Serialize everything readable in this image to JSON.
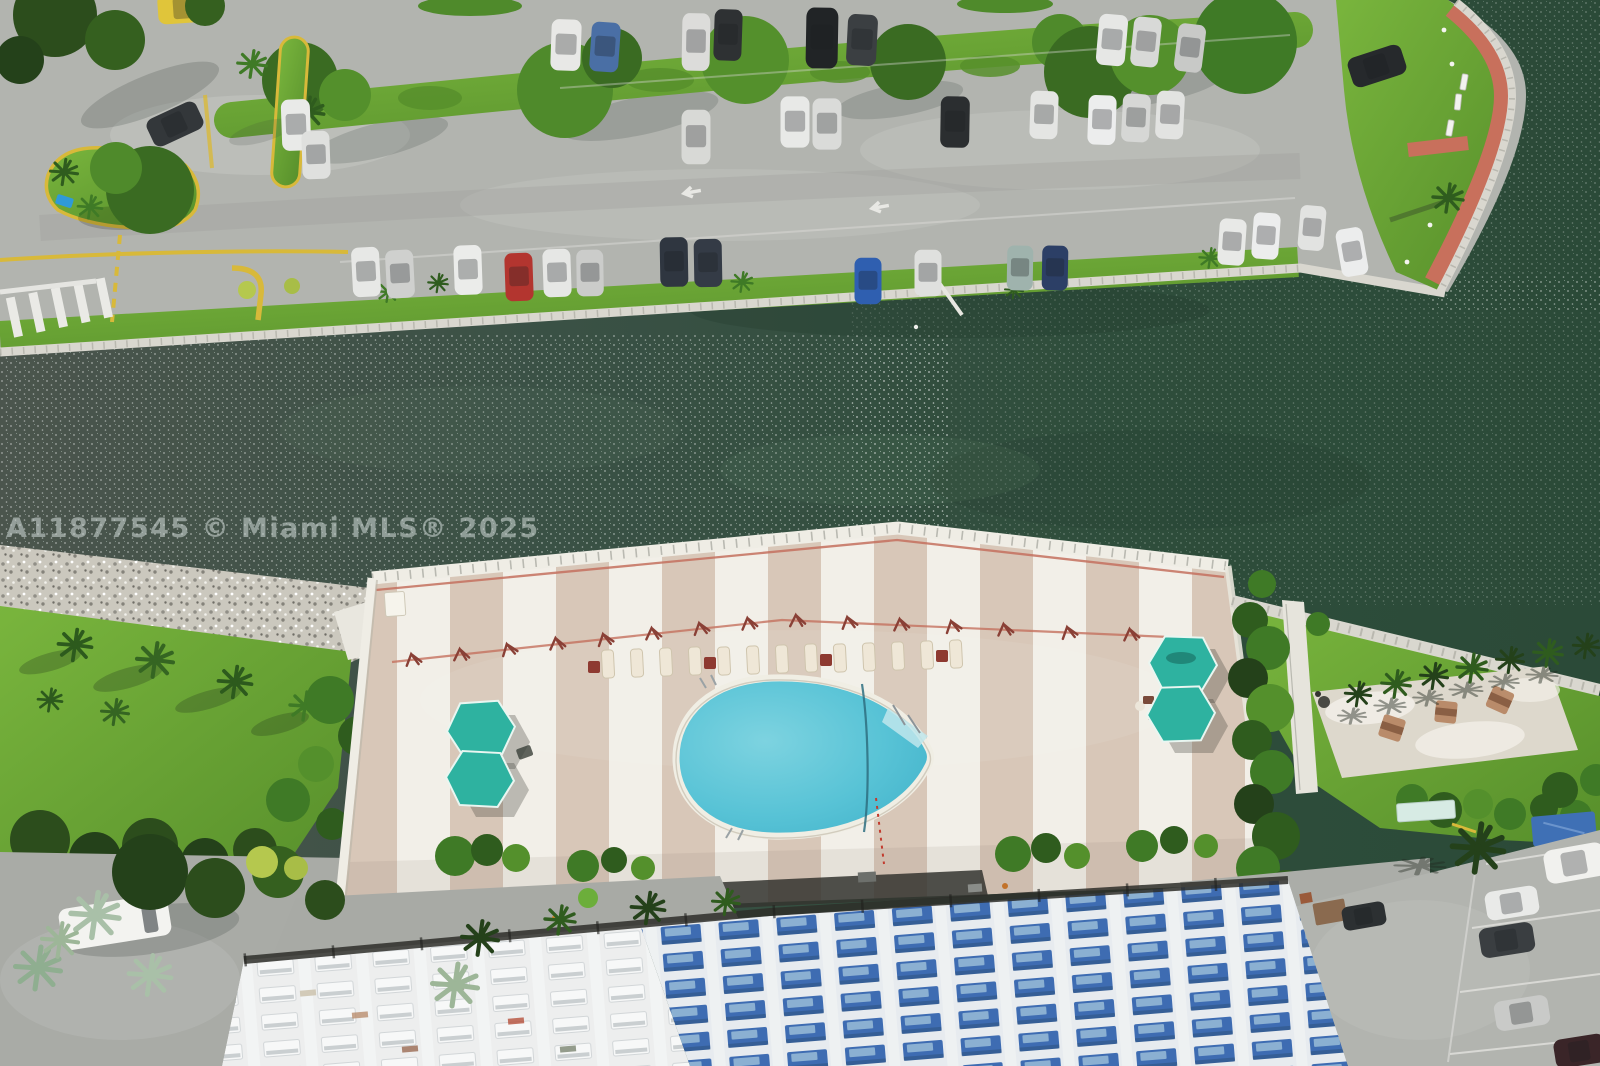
{
  "meta": {
    "title": "Aerial drone photo — waterfront condominium pool deck and canal",
    "image_type": "real-estate listing photograph"
  },
  "watermark": {
    "text": "A11877545 © Miami MLS® 2025"
  },
  "scene": {
    "type": "aerial drone photograph, top-down",
    "subject": "Waterfront condominium grounds: canal with dark green water, north parking lot with landscaped medians, curved seawall park with red brick path, rock riprap shoreline, lawn with palms, striped rooftop pool deck with tear-drop swimming pool, teal hexagonal cabana umbrellas, lounge chairs, east garden with picnic patio, southeast parking, and a high-rise facade with blue balcony awnings",
    "regions": [
      "water-canal",
      "north-parking-lot",
      "peninsula-park",
      "rock-shoreline",
      "west-lawn",
      "pool-deck",
      "swimming-pool",
      "east-garden",
      "southeast-parking",
      "condo-building-facade",
      "southwest-road"
    ]
  },
  "palette": {
    "asphalt": "#b2b4af",
    "asphalt-dark": "#a0a29d",
    "deck-tan": "#d8c7b8",
    "deck-white": "#f2efe8",
    "umbrella": "#2eb2a0",
    "awning": "#3e6cb2",
    "awning-light": "#8fb3d4",
    "watermark": "#c6d0cd",
    "water-1": "#4b554d",
    "water-2": "#3a5145",
    "water-3": "#2e4d3b",
    "water-4": "#2b4a38",
    "grass-light": "#79b53d",
    "grass-dark": "#578f2b",
    "pool": "#58c3d6",
    "brick-path": "#c8705c",
    "rope-red": "#c4705e",
    "seawall": "#d9d7cf",
    "rock": "#cbc8be",
    "netting": "#2e2e29",
    "curb-yellow": "#d8b93a"
  }
}
